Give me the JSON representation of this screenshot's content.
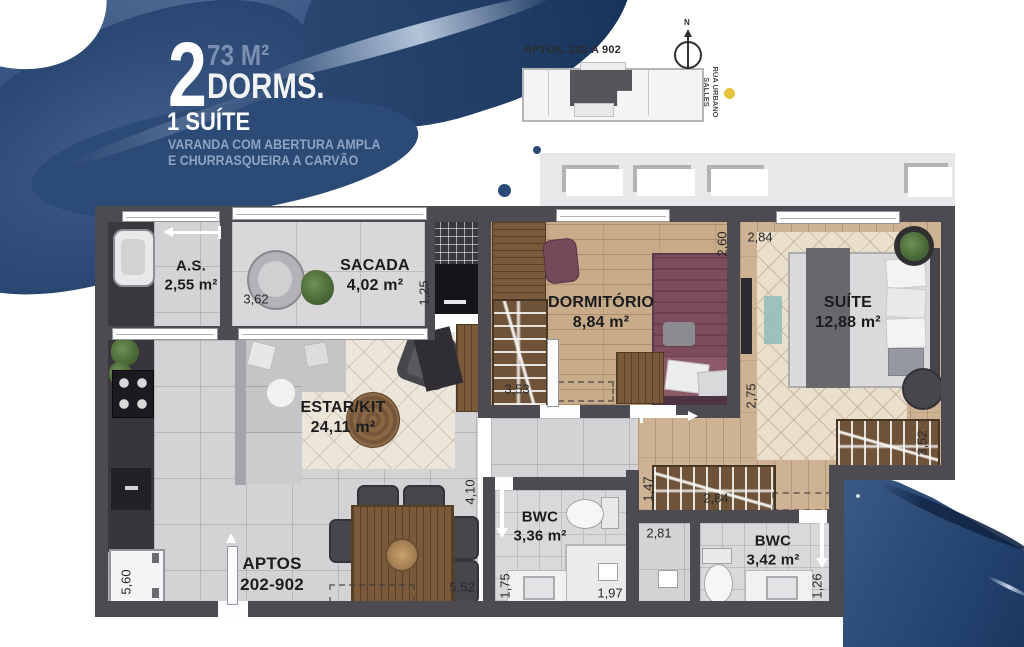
{
  "header": {
    "big_number": "2",
    "area": "73 M²",
    "dorms_label": "DORMS.",
    "suite_label": "1 SUÍTE",
    "desc_line1": "VARANDA COM ABERTURA AMPLA",
    "desc_line2": "E CHURRASQUEIRA A CARVÃO"
  },
  "keyplan": {
    "label": "APTOS. 202 A 902",
    "compass_n": "N",
    "street_line1": "RUA URBANO",
    "street_line2": "SALLES"
  },
  "rooms": {
    "as": {
      "name": "A.S.",
      "area": "2,55 m²"
    },
    "sacada": {
      "name": "SACADA",
      "area": "4,02 m²"
    },
    "dormitorio": {
      "name": "DORMITÓRIO",
      "area": "8,84 m²"
    },
    "suite": {
      "name": "SUÍTE",
      "area": "12,88 m²"
    },
    "estar": {
      "name": "ESTAR/KIT",
      "area": "24,11 m²"
    },
    "bwc1": {
      "name": "BWC",
      "area": "3,36 m²"
    },
    "bwc2": {
      "name": "BWC",
      "area": "3,42 m²"
    }
  },
  "entrance": {
    "line1": "APTOS",
    "line2": "202-902"
  },
  "dims": {
    "d362": "3,62",
    "d125": "1,25",
    "d260": "2,60",
    "d284a": "2,84",
    "d353": "3,53",
    "d275": "2,75",
    "d352": "3,52",
    "d410": "4,10",
    "d147": "1,47",
    "d284b": "2,84",
    "d281": "2,81",
    "d175": "1,75",
    "d197": "1,97",
    "d126": "1,26",
    "d560": "5,60",
    "d552": "5,52"
  },
  "colors": {
    "splash_blue": "#2e4c78",
    "splash_dark": "#1d3a63",
    "wall_gray": "#4d4a51",
    "wood_floor": "#c8ab88",
    "bed_maroon": "#7c4e5d",
    "marker_yellow": "#e6c33c",
    "title_blue": "#7b8fb2",
    "subtitle_blue": "#8fa3c4"
  }
}
